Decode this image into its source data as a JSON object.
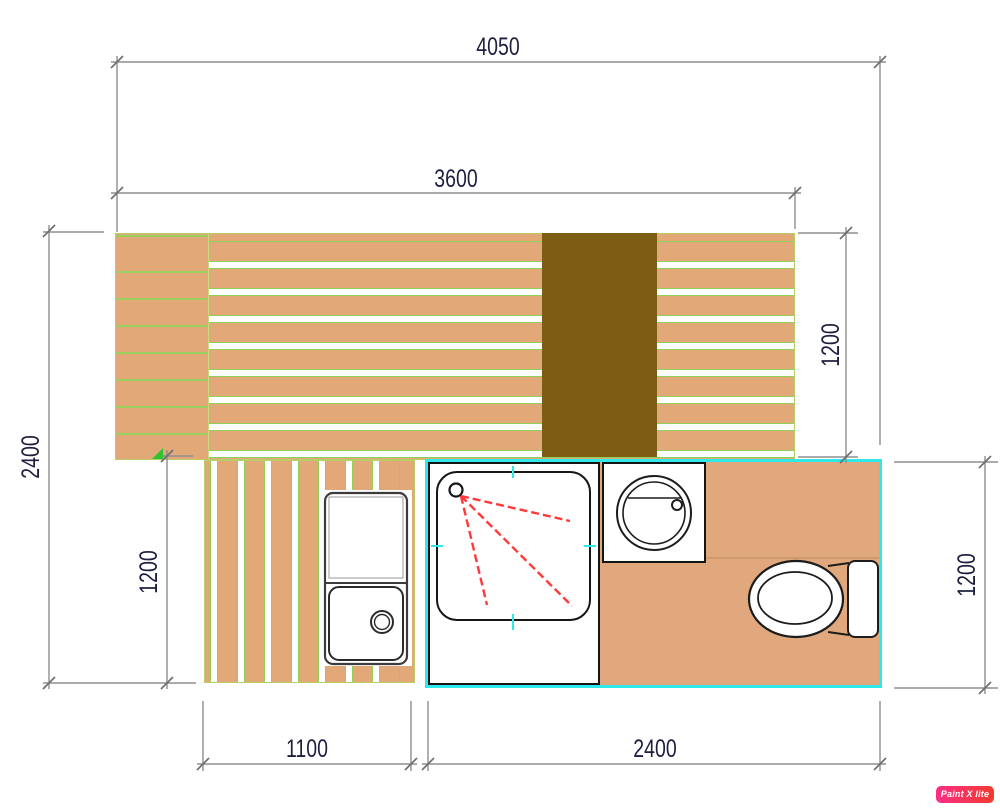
{
  "dimensions": {
    "top_overall": "4050",
    "deck_width": "3600",
    "left_overall": "2400",
    "left_lower": "1200",
    "right_upper": "1200",
    "right_lower": "1200",
    "bottom_walkway": "1100",
    "bottom_bathroom": "2400"
  },
  "watermark": "Paint X lite",
  "colors": {
    "deck_plank_tan": "#e2a878",
    "plank_gap_green": "#8fd158",
    "deck_edge_green": "#b8cc6a",
    "dark_block_brown": "#7d5d13",
    "bathroom_outline_cyan": "#2ee9e9",
    "fixture_outline_black": "#151515",
    "shower_spray_red": "#ff3a3a",
    "dimension_line_gray": "#8f8f8f",
    "dimension_text_navy": "#1e1e3e",
    "watermark_pink": "#fb2e86"
  }
}
